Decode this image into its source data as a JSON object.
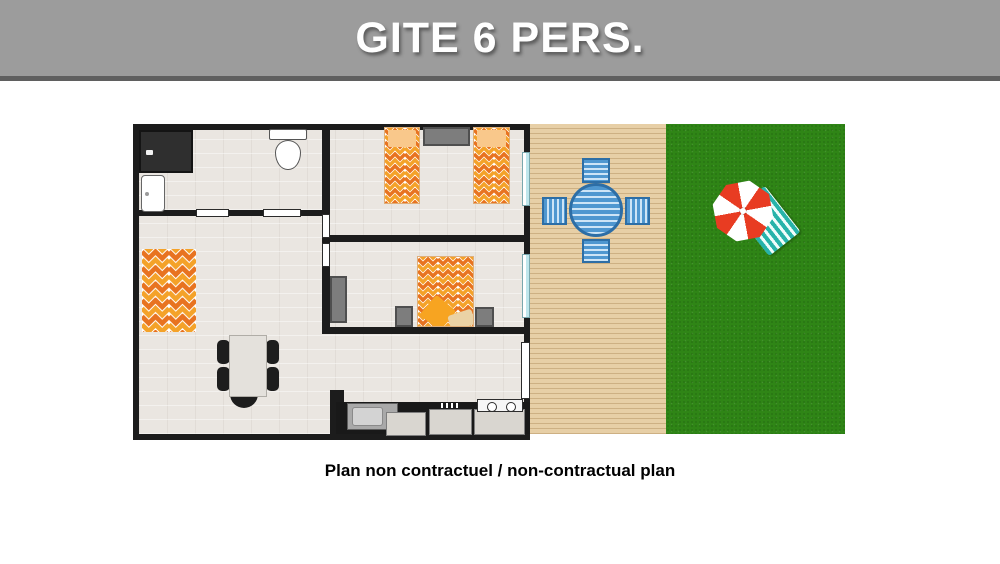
{
  "header": {
    "title": "GITE 6 PERS."
  },
  "caption": {
    "text": "Plan non contractuel / non-contractual plan"
  },
  "colors": {
    "banner": "#9c9c9c",
    "bannerline": "#5f5f5f",
    "wall": "#1c1c1c",
    "floor": "#eae6e1",
    "window": "#bfe6ec",
    "orange1": "#e87320",
    "orange2": "#f4a229",
    "pillow": "#f9c88b",
    "gray": "#7d7d7d",
    "graydark": "#4f4f4f",
    "deck": "#e7cfa6",
    "deckline": "#cdb083",
    "blue": "#4f97d0",
    "bluedark": "#2d6ea6",
    "bluelight": "#cde4f6",
    "grass": "#2f8516",
    "red": "#e83c22",
    "teal": "#27b3aa"
  }
}
